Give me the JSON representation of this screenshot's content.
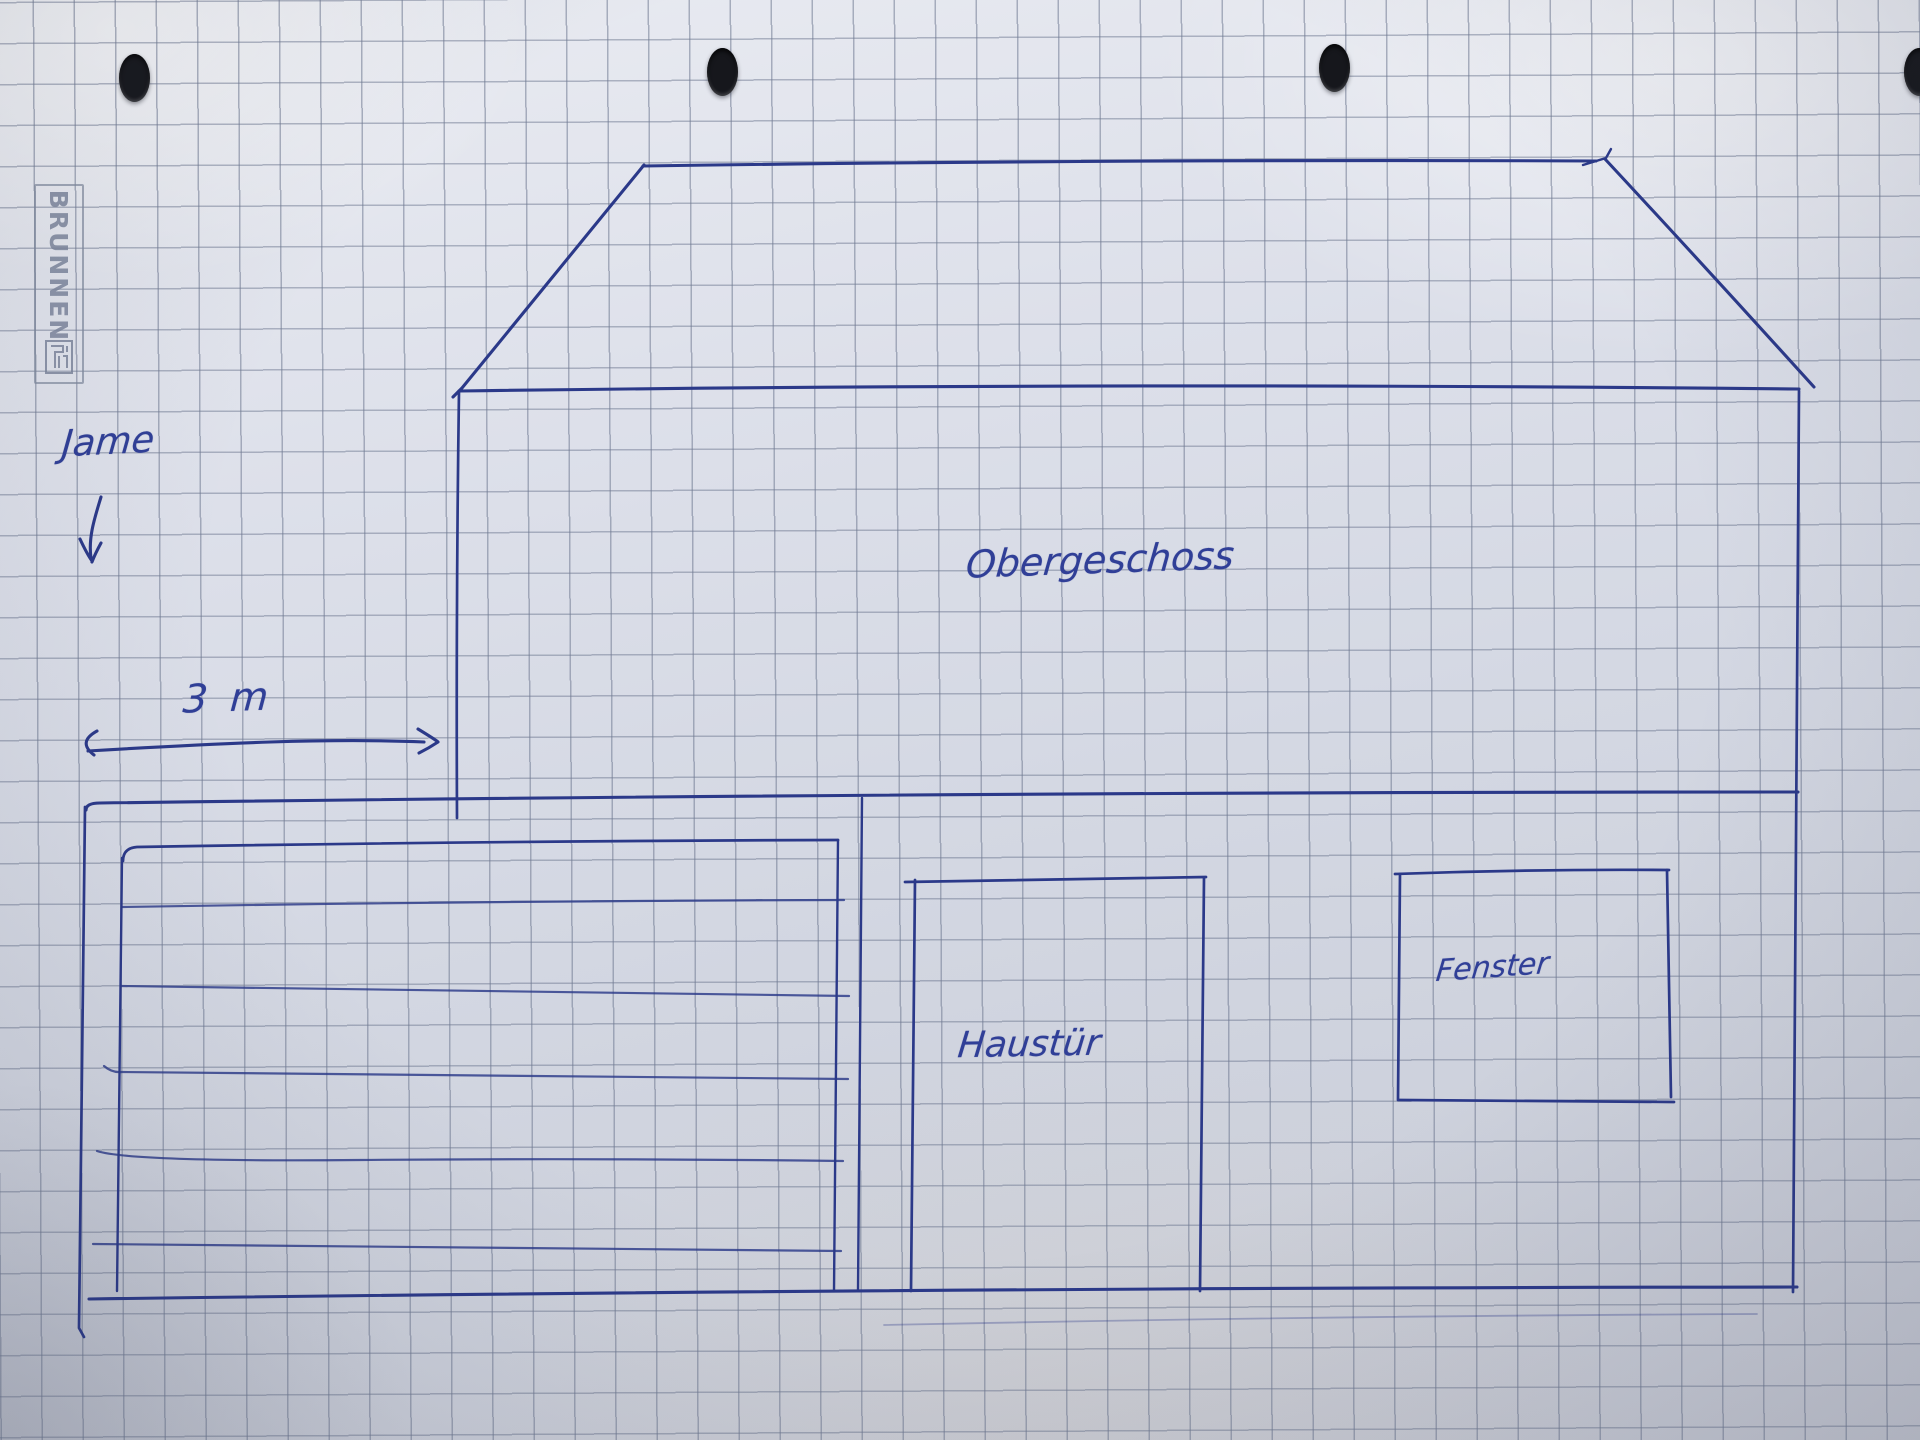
{
  "paper": {
    "brand": "BRUNNEN",
    "kind": "hole-punched squared graph paper sheet, photographed",
    "grid_size_px": 41,
    "punch_hole_count": 4
  },
  "colors": {
    "ink": "#2b3989",
    "grid_line": "#707a92",
    "paper_light": "#eaecf2",
    "paper_dark": "#c5c8d3",
    "watermark": "#7c869c",
    "punch_hole": "#16171c"
  },
  "sketch": {
    "subject": "hand-drawn house front elevation"
  },
  "labels": {
    "handwritten_name": "Jame",
    "width_measurement": "3 m",
    "upper_floor": "Obergeschoss",
    "front_door": "Haustür",
    "window": "Fenster"
  },
  "watermark": {
    "brand_text": "BRUNNEN"
  }
}
